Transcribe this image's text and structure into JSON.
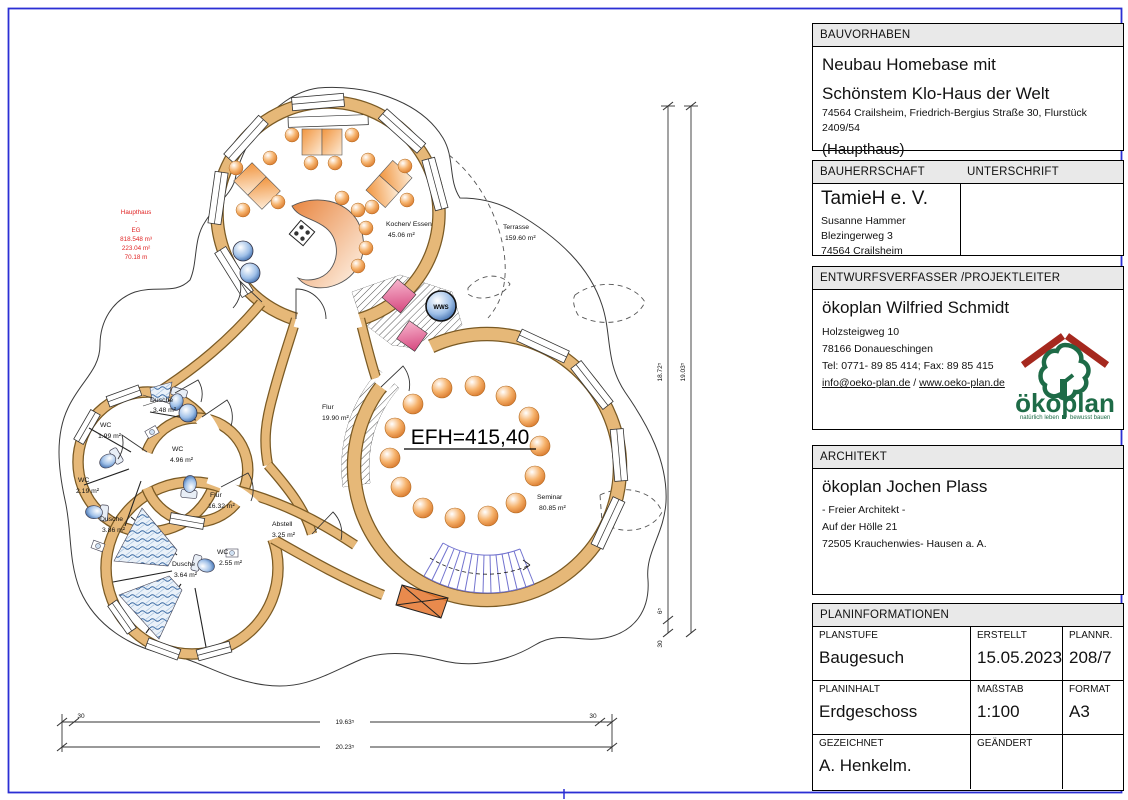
{
  "colors": {
    "frame": "#2b2fd4",
    "wood": "#e6b878",
    "wood_edge": "#7a5a24",
    "red_annotation": "#e02424",
    "stairs_blue": "#7273cf",
    "fixture_blue": "#6b93c4",
    "pink": "#d6487f",
    "furniture_orange": "#e8883c",
    "header_gray": "#e9e9e9",
    "logo_green": "#1e6b47",
    "logo_red": "#a5281e"
  },
  "plan": {
    "red_annotation": [
      "Haupthaus",
      "-",
      "EG",
      "818.548 m³",
      "223.04 m²",
      "70.18 m"
    ],
    "efh_label": "EFH=415,40",
    "wws_label": "WWS",
    "rooms": {
      "kochen": {
        "name": "Kochen/ Essen",
        "area": "45.06 m²"
      },
      "terrasse": {
        "name": "Terrasse",
        "area": "159.60 m²"
      },
      "flur_main": {
        "name": "Flur",
        "area": "19.90 m²"
      },
      "seminar": {
        "name": "Seminar",
        "area": "80.85 m²"
      },
      "flur_west": {
        "name": "Flur",
        "area": "16.32 m²"
      },
      "wc_mid": {
        "name": "WC",
        "area": "4.96 m²"
      },
      "dusche_top": {
        "name": "Dusche",
        "area": "3.48 m²"
      },
      "wc_top": {
        "name": "WC",
        "area": "1.99 m²"
      },
      "wc_left": {
        "name": "WC",
        "area": "2.19 m²"
      },
      "dusche_left": {
        "name": "Dusche",
        "area": "3.86 m²"
      },
      "dusche_bottom": {
        "name": "Dusche",
        "area": "3.64 m²"
      },
      "wc_bottom": {
        "name": "WC",
        "area": "2.55 m²"
      },
      "abstell": {
        "name": "Abstell",
        "area": "3.25 m²"
      }
    },
    "dimensions": {
      "v_inner": "18.72⁵",
      "v_outer": "19.03⁵",
      "v_seg_a": "6⁵",
      "v_seg_b": "30",
      "h_inner": "19.63⁵",
      "h_outer": "20.23⁵",
      "h_left": "30",
      "h_right": "30"
    }
  },
  "titleblock": {
    "bauvorhaben": {
      "header": "BAUVORHABEN",
      "title_line1": "Neubau Homebase mit",
      "title_line2": "Schönstem Klo-Haus der Welt",
      "address": "74564 Crailsheim, Friedrich-Bergius Straße 30, Flurstück 2409/54",
      "subtitle": "(Haupthaus)"
    },
    "bauherrschaft": {
      "header": "BAUHERRSCHAFT",
      "header_right": "UNTERSCHRIFT",
      "name": "TamieH e. V.",
      "contact": "Susanne Hammer",
      "street": "Blezingerweg 3",
      "city": "74564 Crailsheim"
    },
    "entwurfsverfasser": {
      "header": "ENTWURFSVERFASSER /PROJEKTLEITER",
      "name": "ökoplan Wilfried Schmidt",
      "street": "Holzsteigweg 10",
      "city": "78166 Donaueschingen",
      "phone": "Tel: 0771- 89 85 414; Fax: 89 85 415",
      "email": "info@oeko-plan.de",
      "link_separator": " / ",
      "website": "www.oeko-plan.de",
      "logo": {
        "name": "ökoplan",
        "tagline_left": "natürlich leben",
        "tagline_right": "bewusst bauen"
      }
    },
    "architekt": {
      "header": "ARCHITEKT",
      "name": "ökoplan Jochen Plass",
      "role": "- Freier Architekt -",
      "street": "Auf der Hölle 21",
      "city": "72505 Krauchenwies- Hausen a. A."
    },
    "planinformationen": {
      "header": "PLANINFORMATIONEN",
      "cells": [
        {
          "label": "PLANSTUFE",
          "value": "Baugesuch"
        },
        {
          "label": "ERSTELLT",
          "value": "15.05.2023"
        },
        {
          "label": "PLANNR.",
          "value": "208/7"
        },
        {
          "label": "PLANINHALT",
          "value": "Erdgeschoss"
        },
        {
          "label": "MAßSTAB",
          "value": "1:100"
        },
        {
          "label": "FORMAT",
          "value": "A3"
        },
        {
          "label": "GEZEICHNET",
          "value": "A. Henkelm."
        },
        {
          "label": "GEÄNDERT",
          "value": ""
        },
        {
          "label": "",
          "value": ""
        }
      ]
    }
  }
}
